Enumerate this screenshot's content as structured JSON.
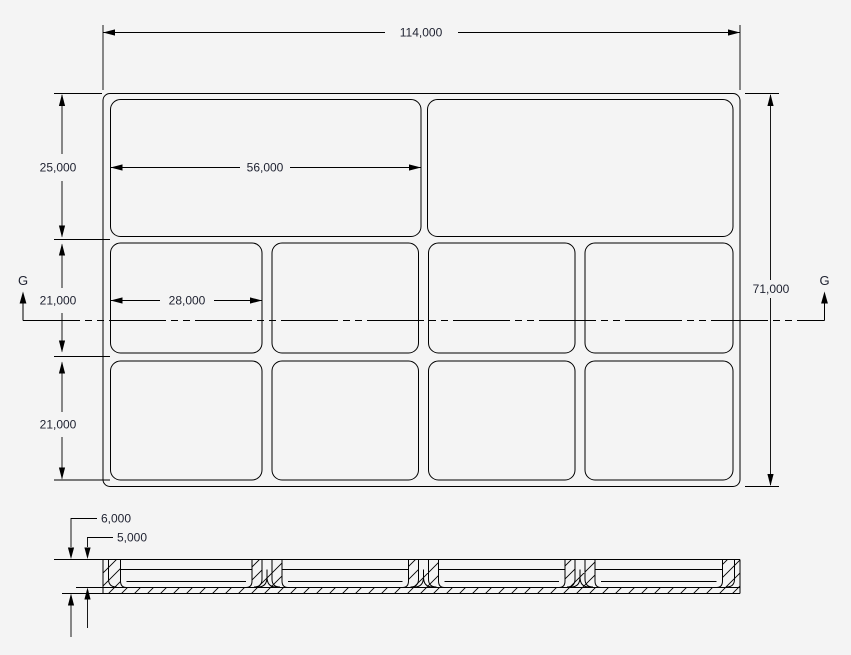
{
  "app": {
    "type": "cad-drawing-view",
    "description": "2D engineering drawing of a rectangular tray with rounded-corner compartments: plan view with dimensions, section cut G-G, and section view with hatching"
  },
  "colors": {
    "background": "#f4f4f4",
    "line": "#000000",
    "dimension_text": "#1e2130"
  },
  "plan_view": {
    "section_marker": "G",
    "compartment_rows": {
      "top": 2,
      "middle": 4,
      "bottom": 4
    },
    "dimensions": {
      "overall_width": "114,000",
      "overall_height": "71,000",
      "row1_height": "25,000",
      "row2_height": "21,000",
      "row3_height": "21,000",
      "top_compartment_width": "56,000",
      "middle_compartment_width": "28,000"
    }
  },
  "section_view": {
    "dimensions": {
      "overall_thickness": "6,000",
      "pocket_depth": "5,000"
    }
  }
}
